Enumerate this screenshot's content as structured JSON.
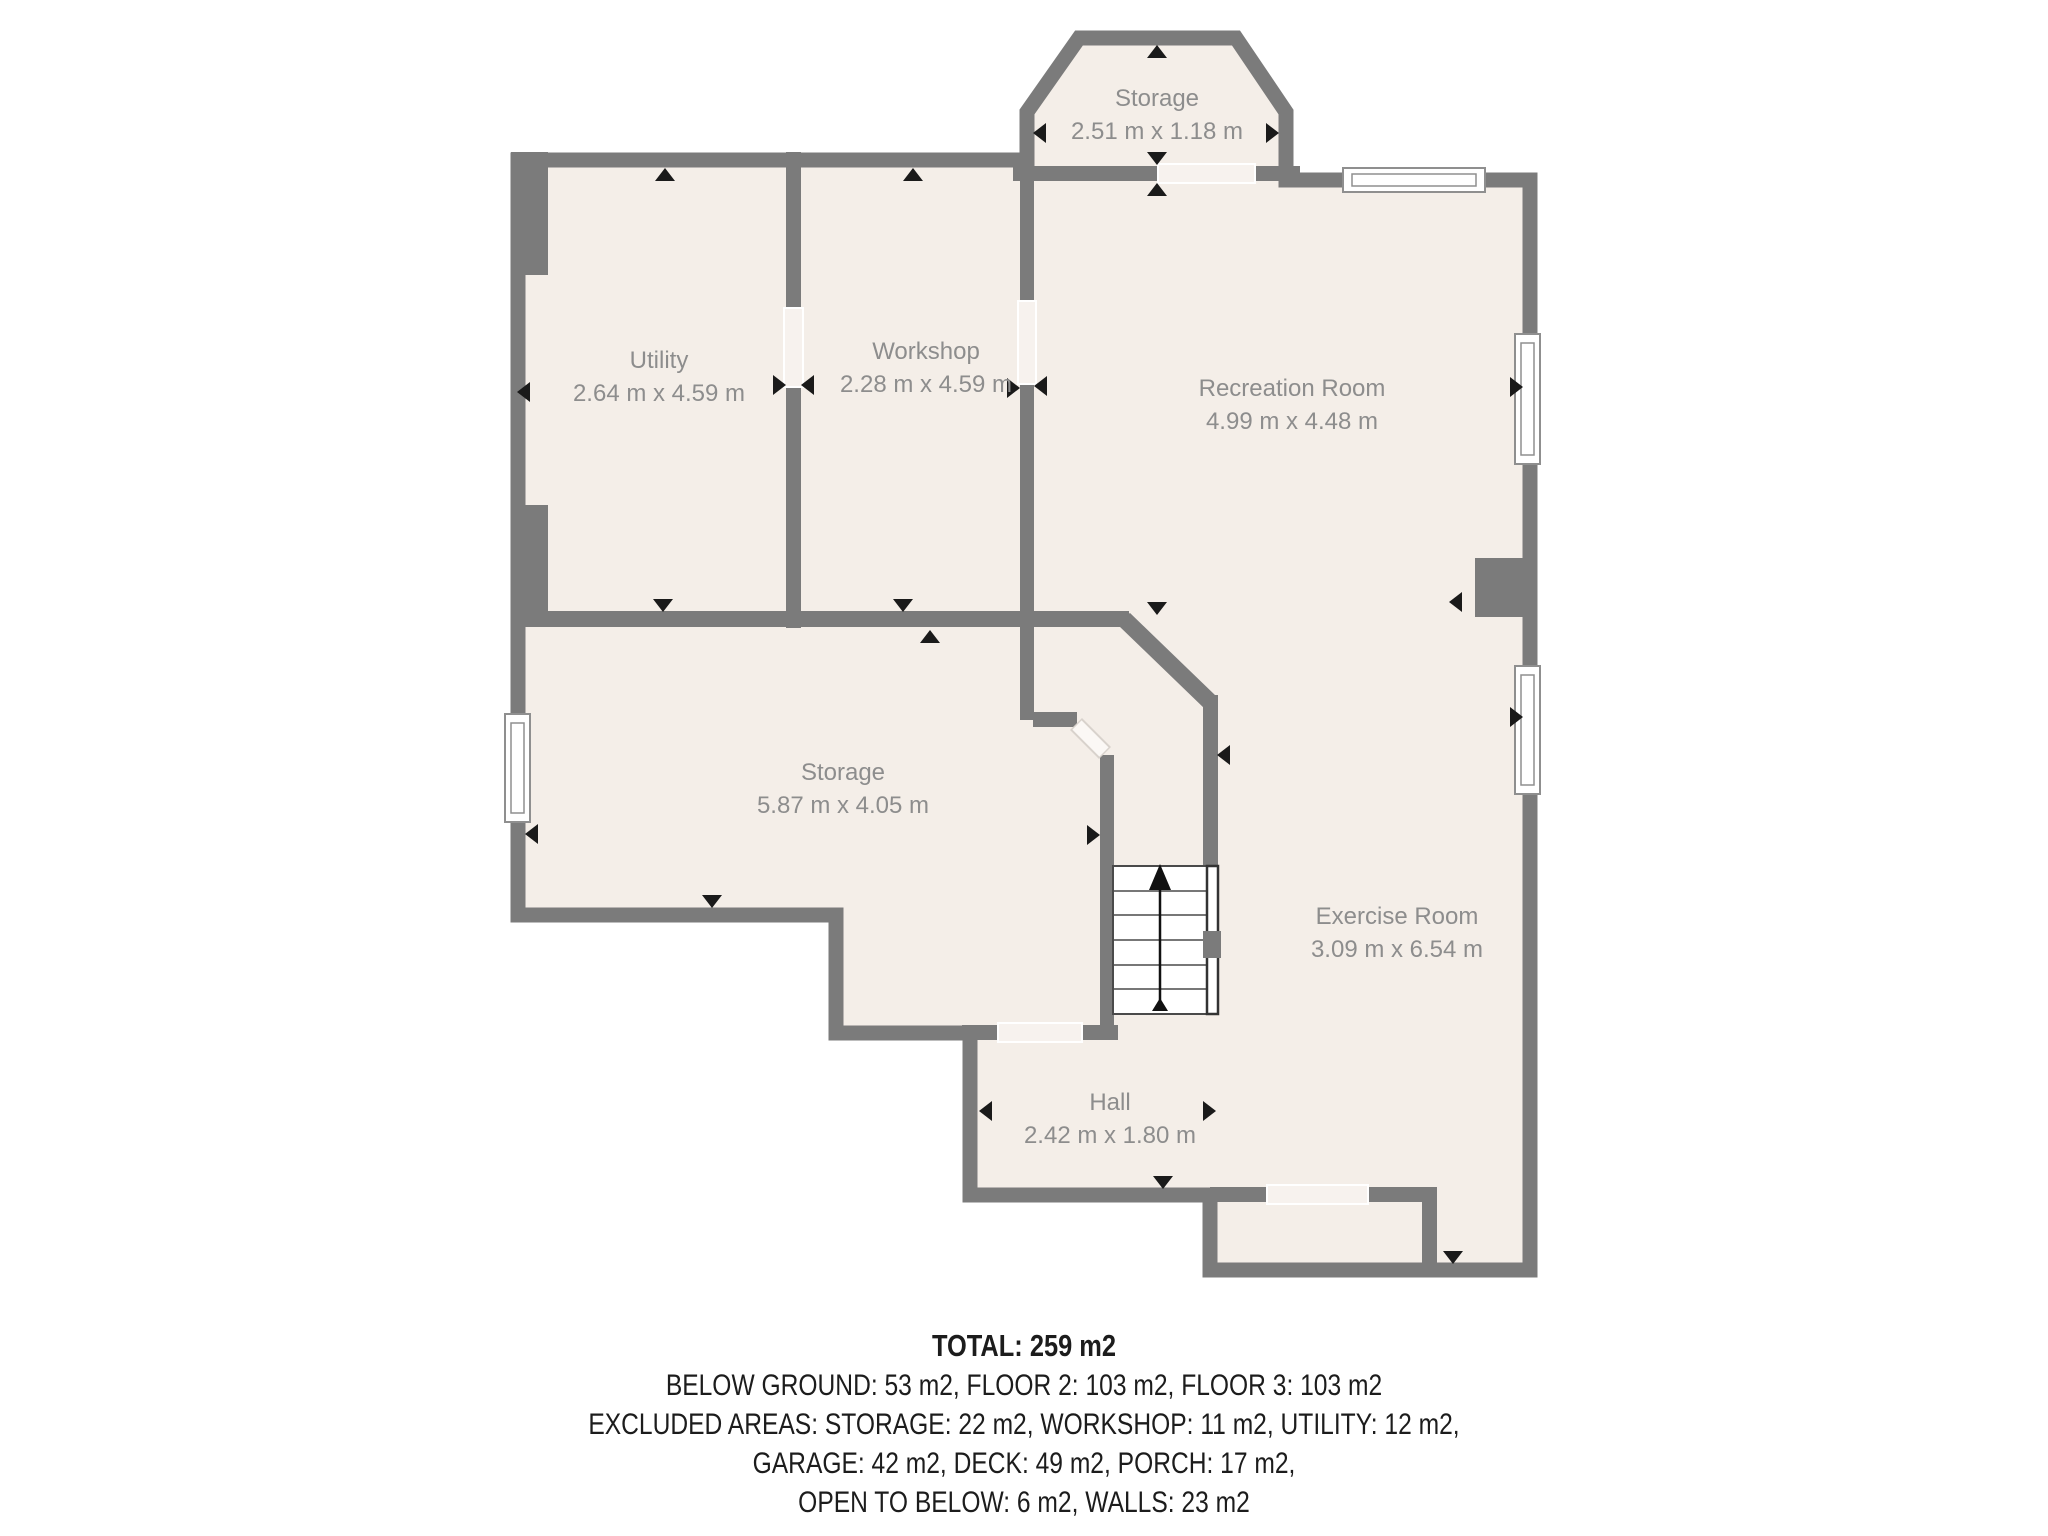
{
  "plan": {
    "colors": {
      "wall": "#7b7b7b",
      "floor": "#f4eee8",
      "opening": "#f7f2ee",
      "label": "#8d8d8d",
      "stairs_outline": "#4a4a4a"
    },
    "rooms": [
      {
        "name": "Storage",
        "dims": "2.51 m x 1.18 m"
      },
      {
        "name": "Utility",
        "dims": "2.64 m x 4.59 m"
      },
      {
        "name": "Workshop",
        "dims": "2.28 m x 4.59 m"
      },
      {
        "name": "Recreation Room",
        "dims": "4.99 m x 4.48 m"
      },
      {
        "name": "Storage",
        "dims": "5.87 m x 4.05 m"
      },
      {
        "name": "Exercise Room",
        "dims": "3.09 m x 6.54 m"
      },
      {
        "name": "Hall",
        "dims": "2.42 m x 1.80 m"
      }
    ]
  },
  "summary": {
    "total": "TOTAL: 259 m2",
    "line1": "BELOW GROUND: 53 m2, FLOOR 2: 103 m2, FLOOR 3: 103 m2",
    "line2": "EXCLUDED AREAS: STORAGE: 22 m2, WORKSHOP: 11 m2, UTILITY: 12 m2,",
    "line3": "GARAGE: 42 m2, DECK: 49 m2, PORCH: 17 m2,",
    "line4": "OPEN TO BELOW: 6 m2, WALLS: 23 m2",
    "disclaimer": "All Measurements Are Approximate"
  }
}
